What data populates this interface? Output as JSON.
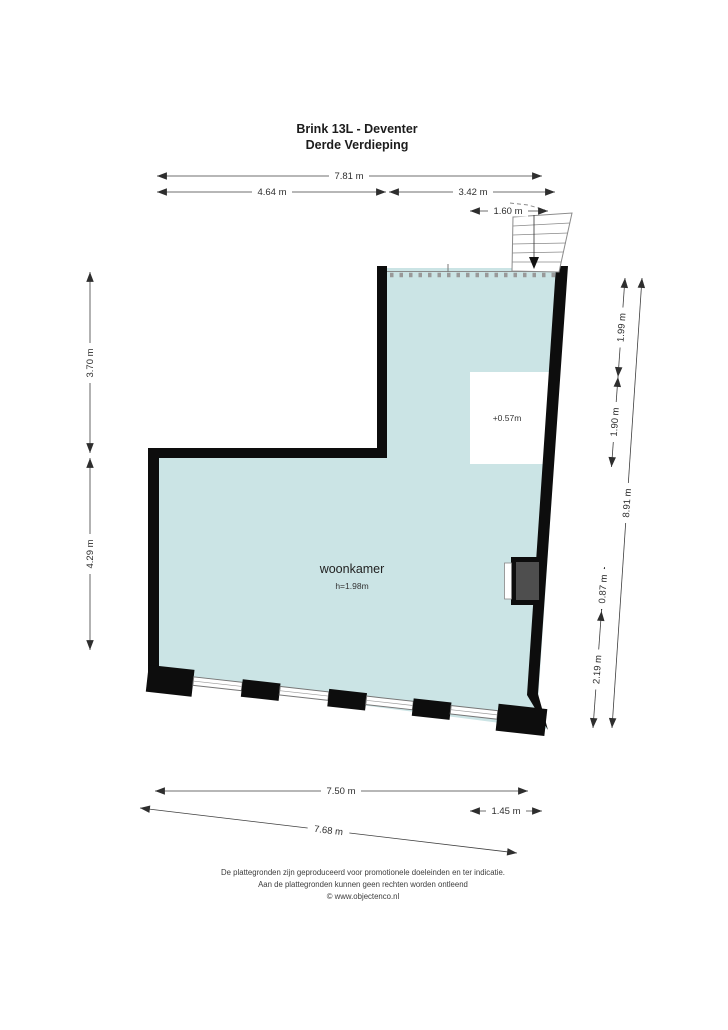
{
  "title": {
    "line1": "Brink 13L - Deventer",
    "line2": "Derde Verdieping"
  },
  "room": {
    "name": "woonkamer",
    "ceiling_height": "h=1.98m",
    "platform_level": "+0.57m"
  },
  "dimensions": {
    "top_total": "7.81 m",
    "top_left": "4.64 m",
    "top_right": "3.42 m",
    "top_stairs": "1.60 m",
    "left_upper": "3.70 m",
    "left_lower": "4.29 m",
    "right_seg1": "1.99 m",
    "right_seg2": "1.90 m",
    "right_seg3": "0.87 m",
    "right_seg4": "2.19 m",
    "right_total": "8.91 m",
    "bottom_inner": "7.50 m",
    "bottom_right": "1.45 m",
    "bottom_outer": "7.68 m"
  },
  "footer": {
    "line1": "De plattegronden zijn geproduceerd voor promotionele doeleinden en ter indicatie.",
    "line2": "Aan de plattegronden kunnen geen rechten worden ontleend",
    "line3": "© www.objectenco.nl"
  },
  "colors": {
    "room_fill": "#cbe4e5",
    "wall": "#0d0d0d",
    "shaft_fill": "#4e4e4e",
    "open_edge": "#999999"
  }
}
